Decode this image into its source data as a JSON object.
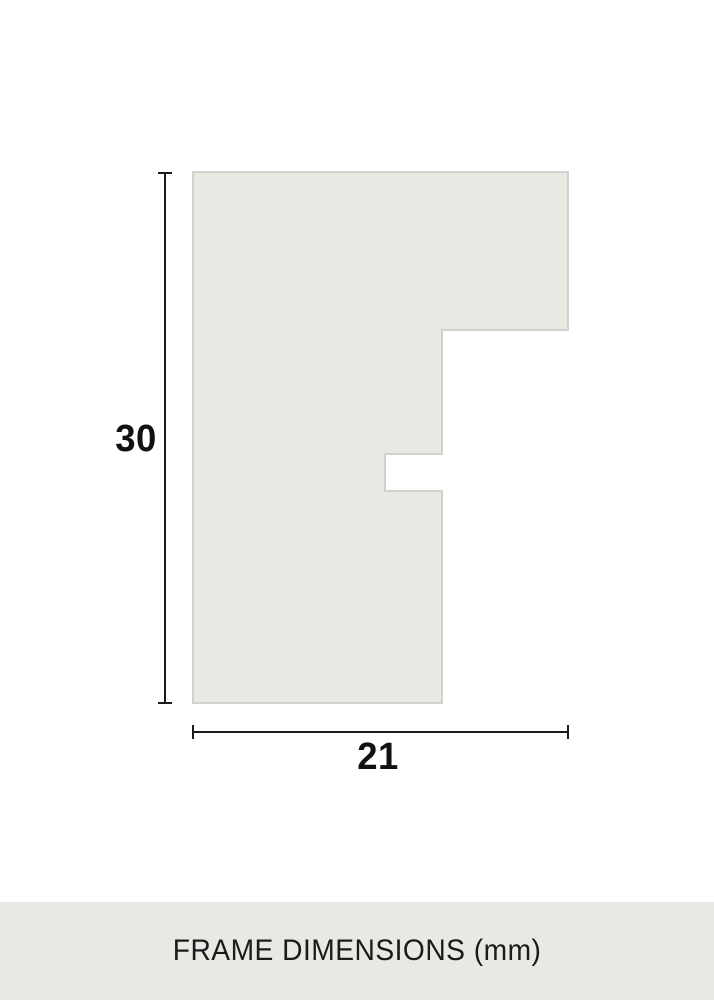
{
  "diagram": {
    "title": "frame moulding cross-section profile",
    "height_label": "30",
    "width_label": "21",
    "unit": "mm"
  },
  "footer": {
    "label": "FRAME DIMENSIONS (mm)"
  },
  "colors": {
    "shape_fill": "#e9e9e4",
    "shape_border": "#d2d2cc",
    "dimension_line": "#1b1b1b",
    "label_text": "#111111",
    "footer_background": "#e8e8e4",
    "page_background": "#ffffff"
  }
}
